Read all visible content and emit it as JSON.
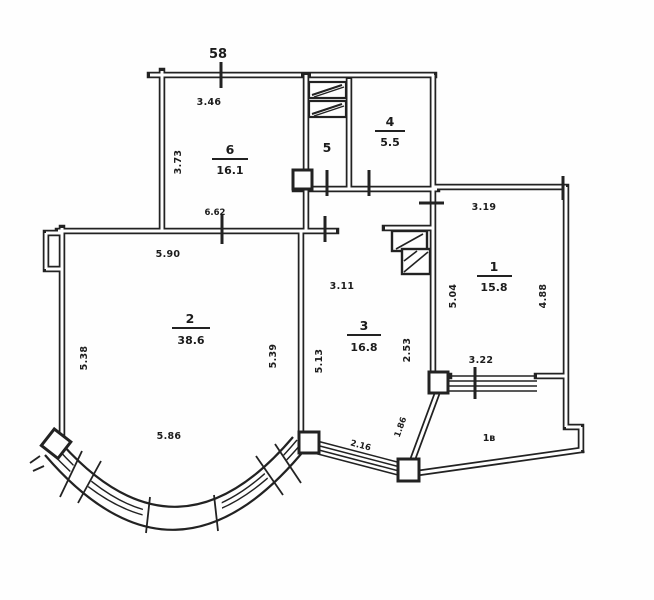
{
  "plan": {
    "unit_number": "58",
    "unit_number_color": "#b5527f",
    "line_color": "#222222",
    "rooms": {
      "r6": {
        "number": "6",
        "area": "16.1"
      },
      "r5": {
        "number": "5"
      },
      "r4": {
        "number": "4",
        "area": "5.5"
      },
      "r1": {
        "number": "1",
        "area": "15.8"
      },
      "r2": {
        "number": "2",
        "area": "38.6"
      },
      "r3": {
        "number": "3",
        "area": "16.8"
      },
      "balcony": {
        "number": "1в"
      }
    },
    "dimensions": {
      "r6_top": "3.46",
      "r6_left": "3.73",
      "r6_bottom": "6.62",
      "r2_top": "5.90",
      "r2_left": "5.38",
      "r2_right": "5.39",
      "r2_bay": "5.86",
      "r3_top": "3.11",
      "r3_left": "5.13",
      "r3_right": "2.53",
      "r1_top": "3.19",
      "r1_left": "5.04",
      "r1_right": "4.88",
      "r1_bottom": "3.22",
      "balcony_window": "2.16",
      "balcony_wall": "1.86"
    }
  }
}
